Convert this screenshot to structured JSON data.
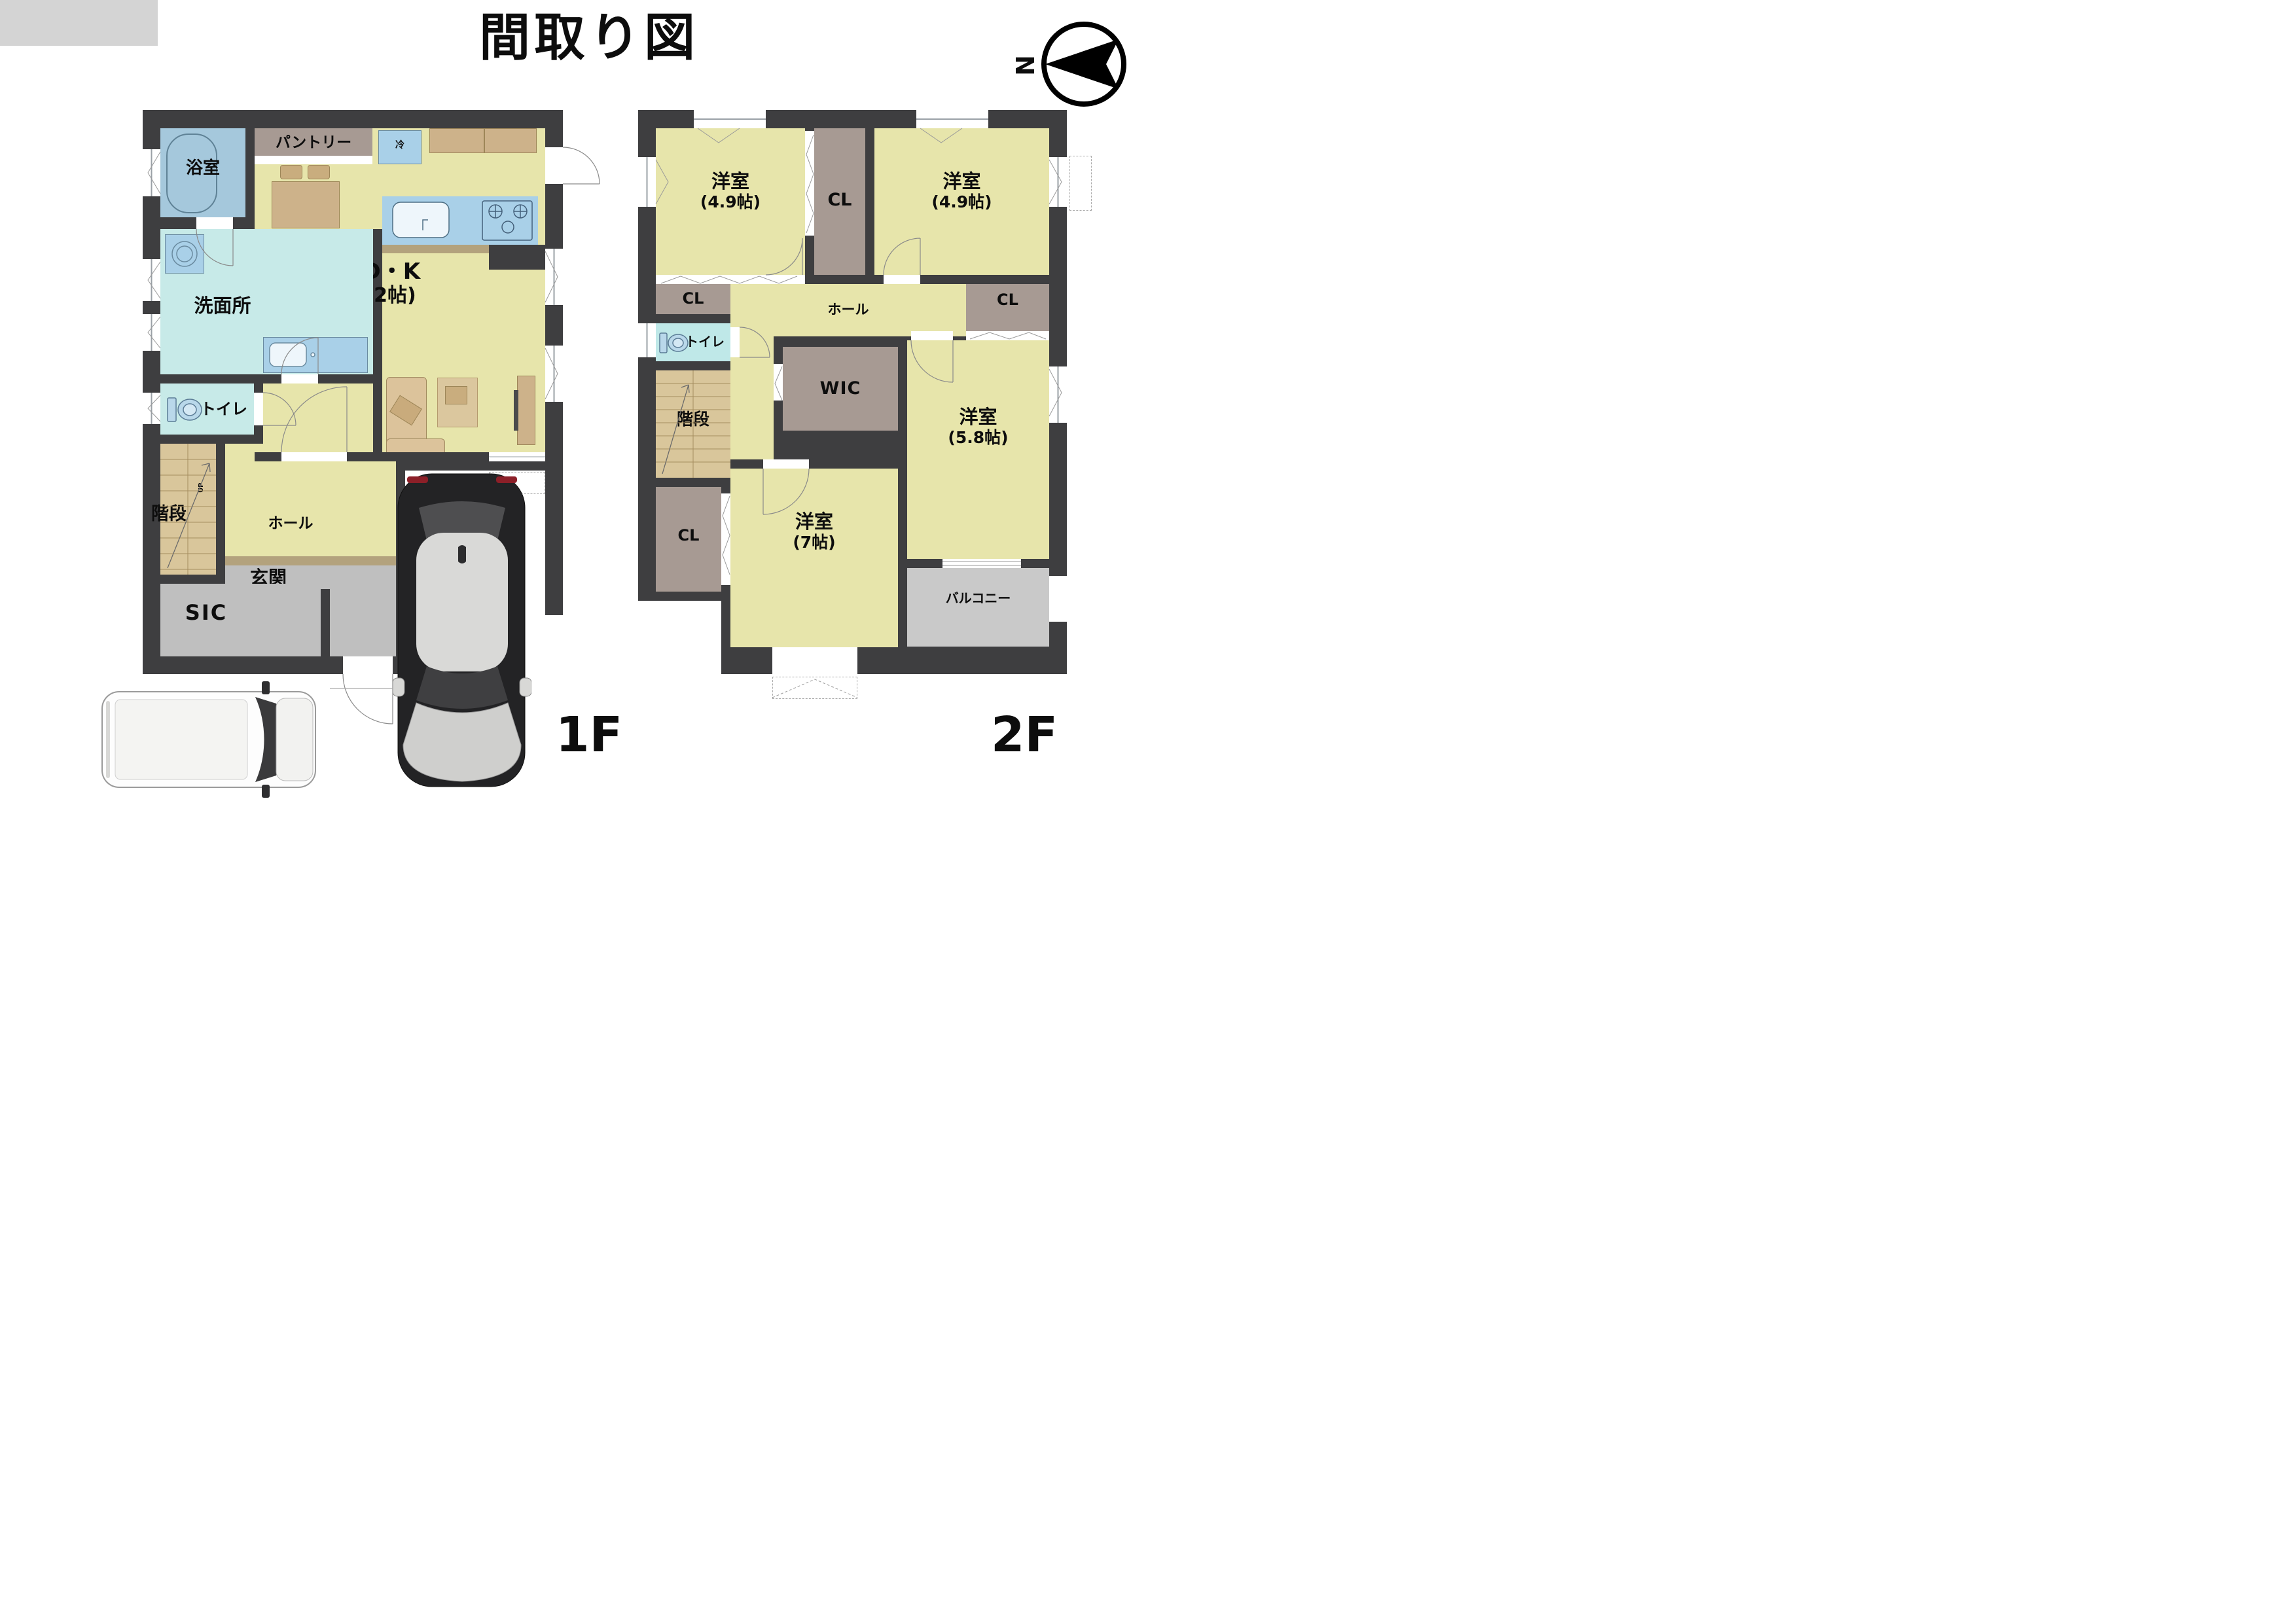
{
  "title": "間取り図",
  "compass": {
    "north_label": "N"
  },
  "floor1": {
    "floor_label": "1F",
    "rooms": {
      "bath": {
        "label": "浴室"
      },
      "pantry": {
        "label": "パントリー"
      },
      "fridge": {
        "label": "冷"
      },
      "ldk": {
        "label": "L・D・K",
        "area": "(17.2帖)"
      },
      "washroom": {
        "label": "洗面所"
      },
      "toilet": {
        "label": "トイレ"
      },
      "stairs": {
        "label": "階段",
        "direction": "UP"
      },
      "hall": {
        "label": "ホール"
      },
      "entrance": {
        "label": "玄関"
      },
      "sic": {
        "label": "SIC"
      }
    }
  },
  "floor2": {
    "floor_label": "2F",
    "rooms": {
      "bedroom_nw": {
        "label": "洋室",
        "area": "(4.9帖)"
      },
      "bedroom_ne": {
        "label": "洋室",
        "area": "(4.9帖)"
      },
      "bedroom_e": {
        "label": "洋室",
        "area": "(5.8帖)"
      },
      "bedroom_s": {
        "label": "洋室",
        "area": "(7帖)"
      },
      "cl_top": {
        "label": "CL"
      },
      "cl_left": {
        "label": "CL"
      },
      "cl_right": {
        "label": "CL"
      },
      "cl_bottom": {
        "label": "CL"
      },
      "wic": {
        "label": "WIC"
      },
      "hall": {
        "label": "ホール"
      },
      "toilet": {
        "label": "トイレ"
      },
      "stairs": {
        "label": "階段"
      },
      "balcony": {
        "label": "バルコニー"
      }
    }
  },
  "colors": {
    "wall": "#3e3e40",
    "room_yellow": "#e7e5ab",
    "room_cyan": "#c7eae8",
    "bath_blue": "#a5c8dc",
    "fixture_blue": "#a9d0e8",
    "closet_gray": "#a79a93",
    "entry_gray": "#bfbfbf",
    "balcony_gray": "#c9c9c9",
    "stairs_tan": "#d9c69b",
    "furniture_tan": "#cdb28a"
  }
}
